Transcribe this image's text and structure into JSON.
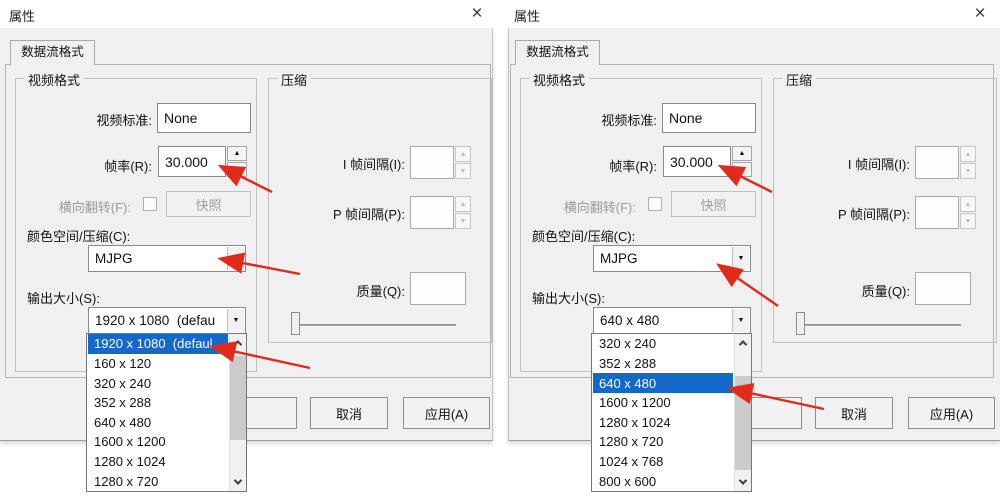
{
  "colors": {
    "dialog_background": "#f0f0f0",
    "selection_highlight": "#1469c8",
    "annotation_arrow_red": "#e02a1a"
  },
  "icons": {
    "close": "×",
    "combo_arrow": "▼",
    "spin_up": "▲",
    "spin_down": "▼"
  },
  "dialogs": [
    {
      "title": "属性",
      "tab_label": "数据流格式",
      "video_format": {
        "group_label": "视频格式",
        "video_standard": {
          "label": "视频标准:",
          "value": "None"
        },
        "frame_rate": {
          "label": "帧率(R):",
          "value": "30.000"
        },
        "flip": {
          "label": "横向翻转(F):",
          "checked": false
        },
        "snapshot_button_label": "快照",
        "color_space": {
          "label": "颜色空间/压缩(C):",
          "value": "MJPG"
        },
        "output_size": {
          "label": "输出大小(S):",
          "value": "1920 x 1080  (defau"
        }
      },
      "compression": {
        "group_label": "压缩",
        "i_frame_interval_label": "I 帧间隔(I):",
        "p_frame_interval_label": "P 帧间隔(P):",
        "quality_label": "质量(Q):"
      },
      "footer_buttons": {
        "cancel": "取消",
        "apply": "应用(A)"
      },
      "output_size_dropdown": {
        "selected": "1920 x 1080  (defaul",
        "selected_index": 0,
        "items": [
          "1920 x 1080  (defaul",
          "160 x 120",
          "320 x 240",
          "352 x 288",
          "640 x 480",
          "1600 x 1200",
          "1280 x 1024",
          "1280 x 720"
        ]
      }
    },
    {
      "title": "属性",
      "tab_label": "数据流格式",
      "video_format": {
        "group_label": "视频格式",
        "video_standard": {
          "label": "视频标准:",
          "value": "None"
        },
        "frame_rate": {
          "label": "帧率(R):",
          "value": "30.000"
        },
        "flip": {
          "label": "横向翻转(F):",
          "checked": false
        },
        "snapshot_button_label": "快照",
        "color_space": {
          "label": "颜色空间/压缩(C):",
          "value": "MJPG"
        },
        "output_size": {
          "label": "输出大小(S):",
          "value": "640 x 480"
        }
      },
      "compression": {
        "group_label": "压缩",
        "i_frame_interval_label": "I 帧间隔(I):",
        "p_frame_interval_label": "P 帧间隔(P):",
        "quality_label": "质量(Q):"
      },
      "footer_buttons": {
        "cancel": "取消",
        "apply": "应用(A)"
      },
      "output_size_dropdown": {
        "selected": "640 x 480",
        "selected_index": 2,
        "items": [
          "320 x 240",
          "352 x 288",
          "640 x 480",
          "1600 x 1200",
          "1280 x 1024",
          "1280 x 720",
          "1024 x 768",
          "800 x 600"
        ]
      }
    }
  ]
}
